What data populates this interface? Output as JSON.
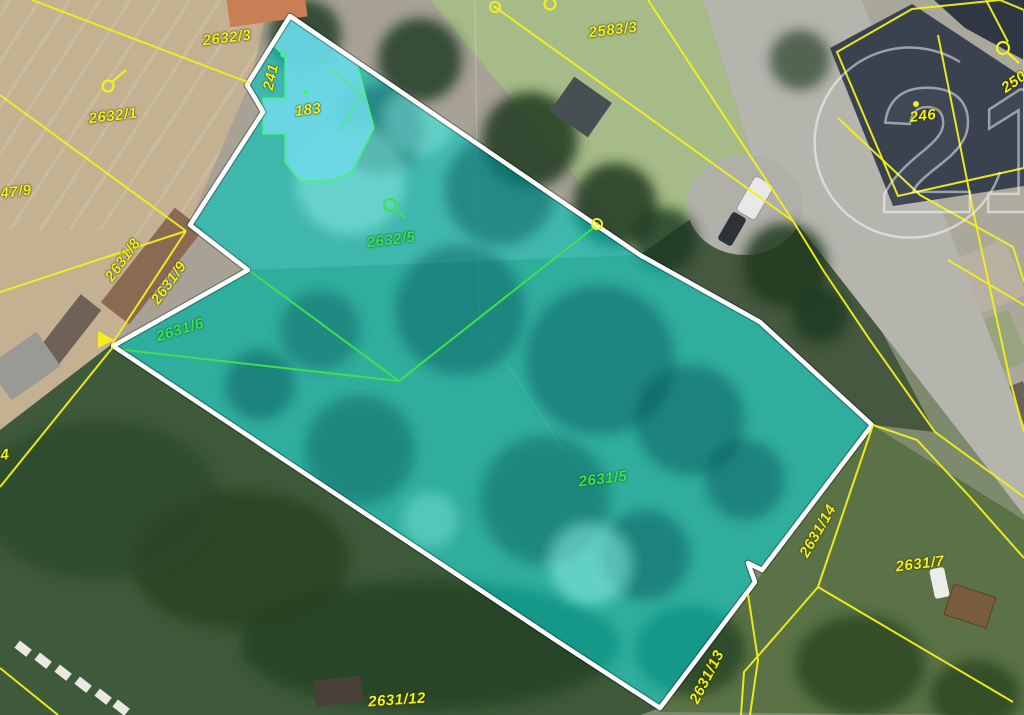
{
  "watermark": {
    "text": "21"
  },
  "map": {
    "type": "cadastral-aerial-map",
    "highlight": {
      "parcel_fill": "#00C3BC",
      "boundary_color": "#FFFFFF",
      "building_fill": "#6ED9E8",
      "cadastral_line_yellow": "#F2EF1D",
      "cadastral_line_green": "#3CE14F"
    },
    "labels": [
      {
        "text": "2632/3",
        "color": "yellow",
        "x": 227,
        "y": 38,
        "rot": -7
      },
      {
        "text": "2583/3",
        "color": "yellow",
        "x": 613,
        "y": 30,
        "rot": -7
      },
      {
        "text": "2632/1",
        "color": "yellow",
        "x": 113,
        "y": 116,
        "rot": -7
      },
      {
        "text": "47/9",
        "color": "yellow",
        "x": 16,
        "y": 192,
        "rot": -7
      },
      {
        "text": "241",
        "color": "yellow",
        "x": 271,
        "y": 77,
        "rot": -78
      },
      {
        "text": "183",
        "color": "yellow",
        "x": 308,
        "y": 110,
        "rot": -7
      },
      {
        "text": "246",
        "color": "yellow",
        "x": 923,
        "y": 116,
        "rot": -7
      },
      {
        "text": "250",
        "color": "yellow",
        "x": 1014,
        "y": 82,
        "rot": -35
      },
      {
        "text": "2631/8",
        "color": "yellow",
        "x": 123,
        "y": 260,
        "rot": -54
      },
      {
        "text": "2631/9",
        "color": "yellow",
        "x": 169,
        "y": 283,
        "rot": -54
      },
      {
        "text": "2631/6",
        "color": "green",
        "x": 180,
        "y": 330,
        "rot": -17
      },
      {
        "text": "2632/5",
        "color": "green",
        "x": 391,
        "y": 240,
        "rot": -7
      },
      {
        "text": "2631/5",
        "color": "green",
        "x": 603,
        "y": 479,
        "rot": -7
      },
      {
        "text": "2631/14",
        "color": "yellow",
        "x": 818,
        "y": 531,
        "rot": -60
      },
      {
        "text": "2631/7",
        "color": "yellow",
        "x": 920,
        "y": 564,
        "rot": -7
      },
      {
        "text": "2631/13",
        "color": "yellow",
        "x": 707,
        "y": 677,
        "rot": -63
      },
      {
        "text": "2631/12",
        "color": "yellow",
        "x": 397,
        "y": 700,
        "rot": -4
      },
      {
        "text": "4",
        "color": "yellow",
        "x": 5,
        "y": 455,
        "rot": -7
      }
    ],
    "symbols": {
      "boundary_point_marker": "yellow-circle",
      "land_use_symbol_yellow": "p-glyph",
      "land_use_symbol_green": "q-glyph",
      "building_point_green": "green-dot",
      "building_point_yellow": "yellow-dot"
    }
  }
}
